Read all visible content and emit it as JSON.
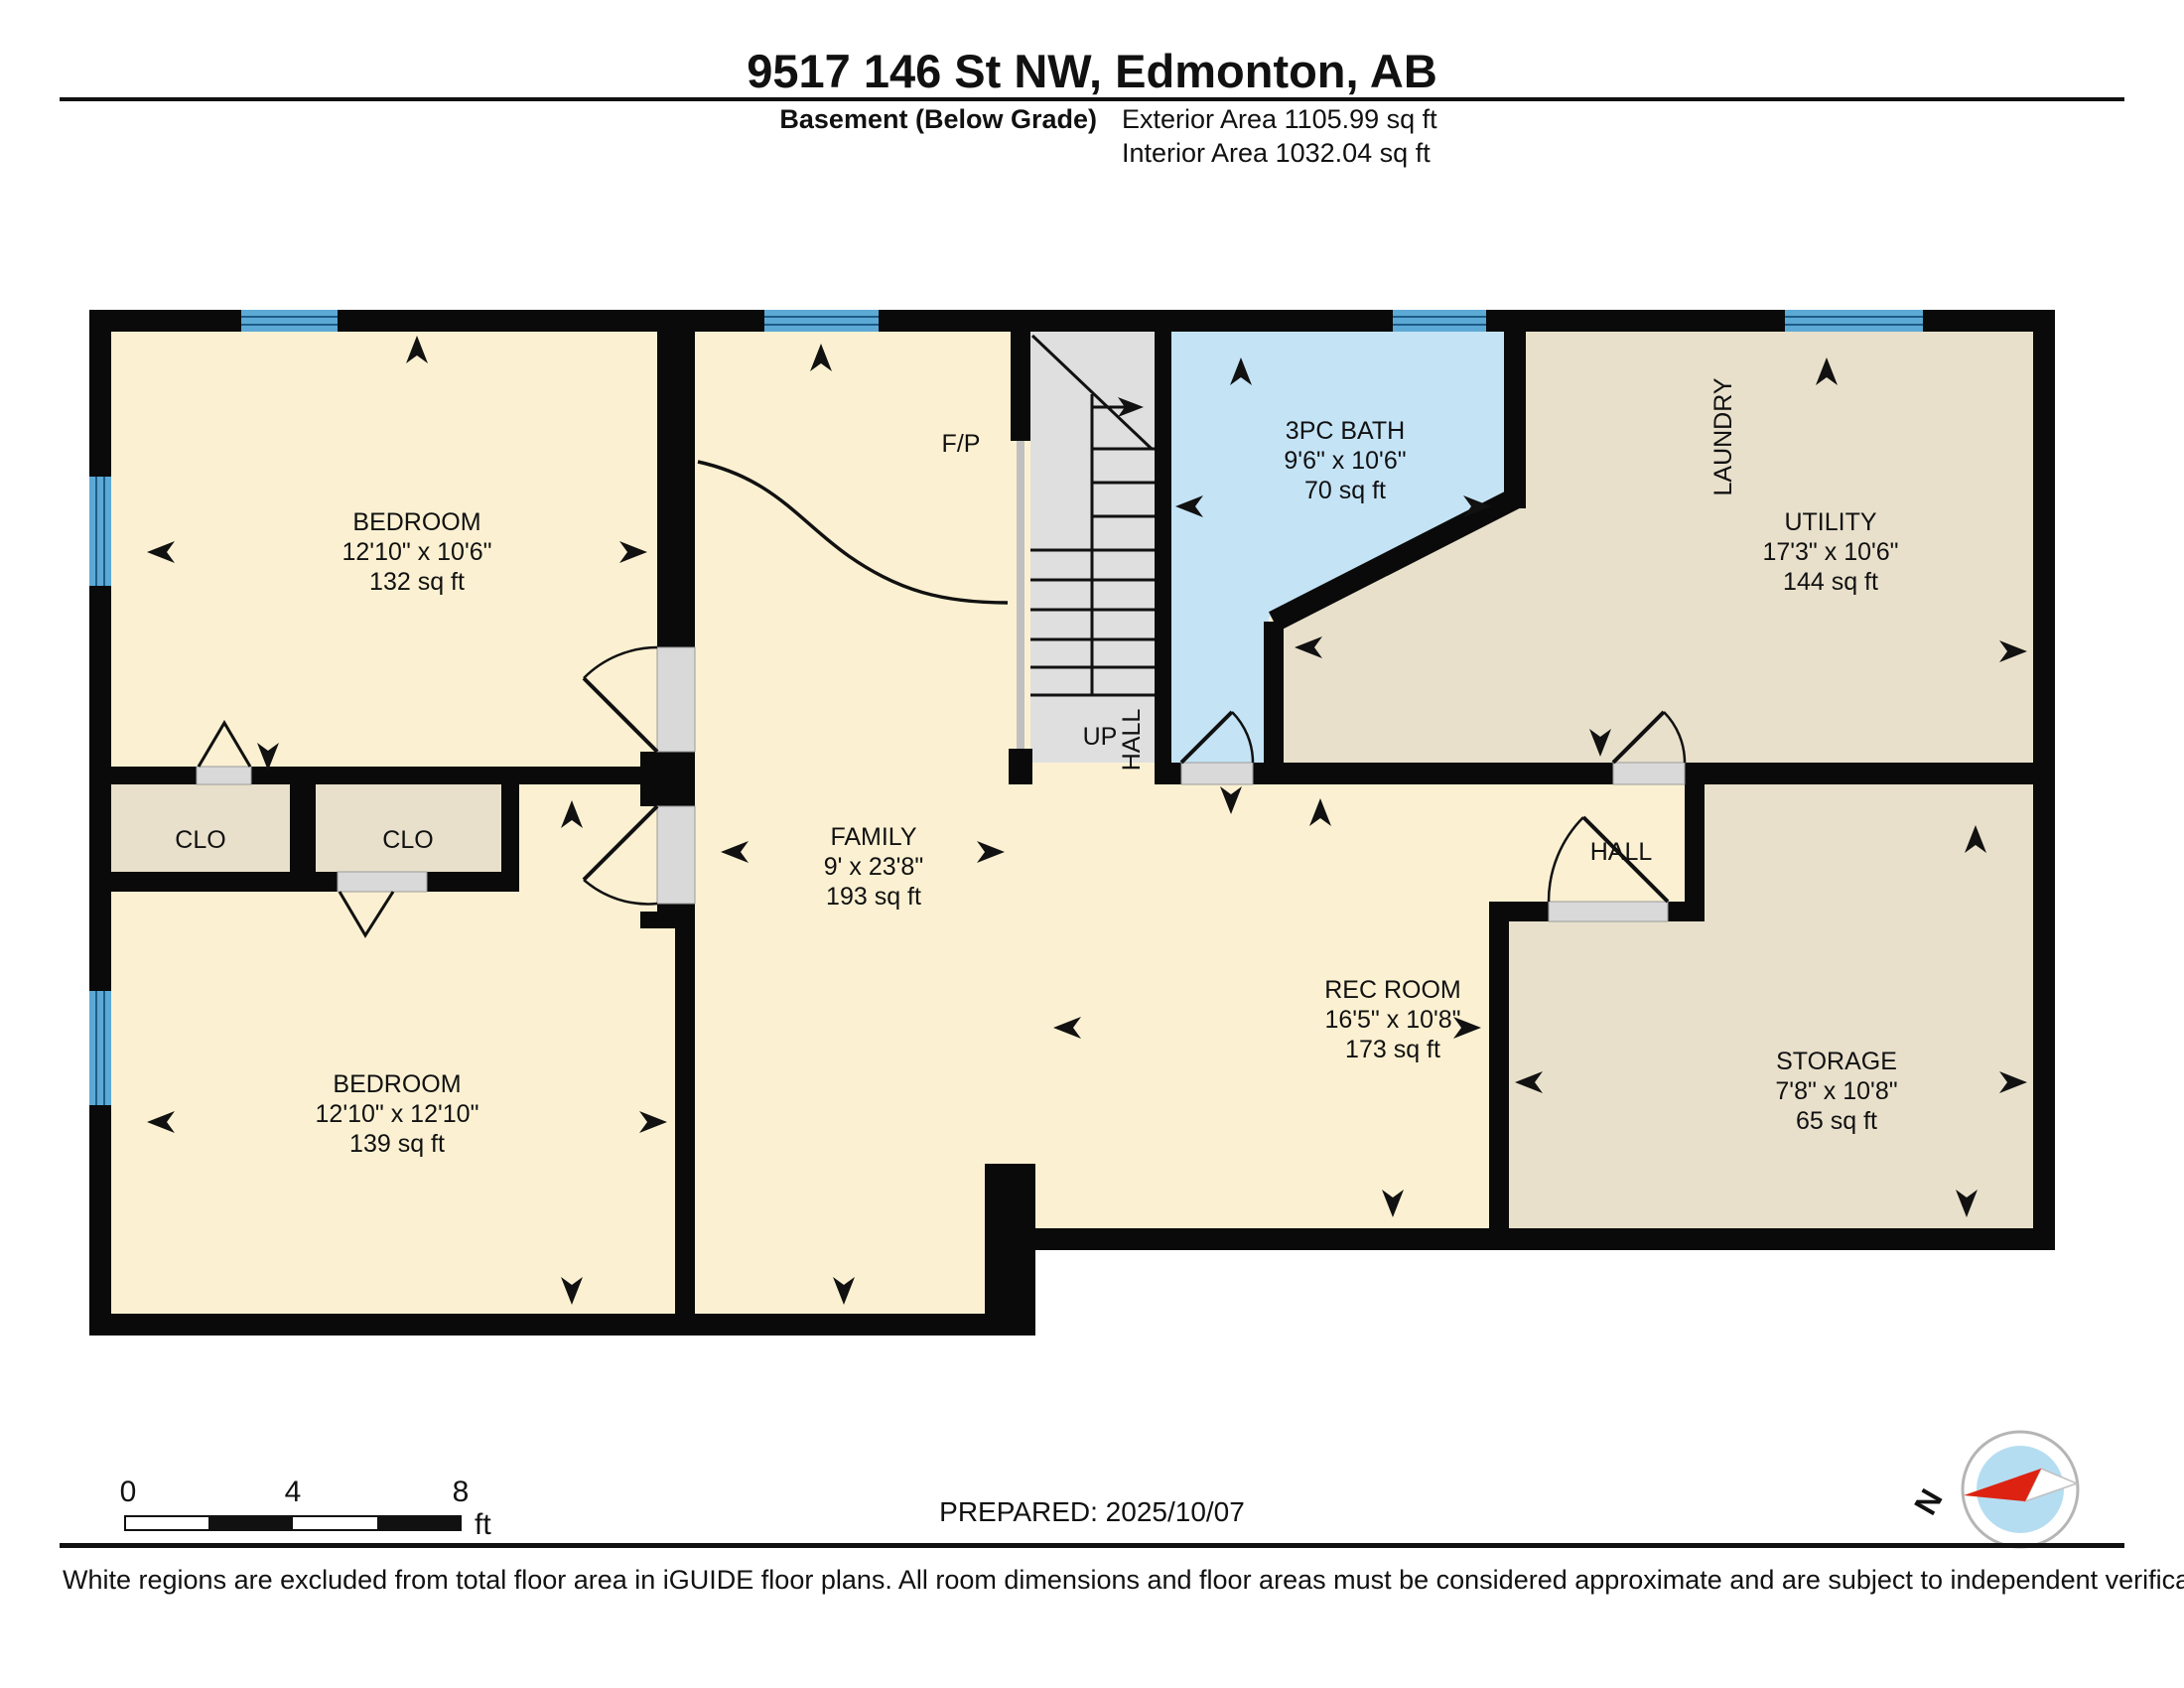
{
  "header": {
    "title": "9517 146 St NW, Edmonton, AB",
    "floor_label": "Basement (Below Grade)",
    "exterior_area": "Exterior Area 1105.99 sq ft",
    "interior_area": "Interior Area 1032.04 sq ft"
  },
  "rooms": [
    {
      "id": "bedroom-1",
      "name": "BEDROOM",
      "dims": "12'10\" x 10'6\"",
      "area": "132 sq ft"
    },
    {
      "id": "bedroom-2",
      "name": "BEDROOM",
      "dims": "12'10\" x 12'10\"",
      "area": "139 sq ft"
    },
    {
      "id": "family",
      "name": "FAMILY",
      "dims": "9' x 23'8\"",
      "area": "193 sq ft"
    },
    {
      "id": "bath",
      "name": "3PC BATH",
      "dims": "9'6\" x 10'6\"",
      "area": "70 sq ft"
    },
    {
      "id": "utility",
      "name": "UTILITY",
      "dims": "17'3\" x 10'6\"",
      "area": "144 sq ft"
    },
    {
      "id": "rec-room",
      "name": "REC ROOM",
      "dims": "16'5\" x 10'8\"",
      "area": "173 sq ft"
    },
    {
      "id": "storage",
      "name": "STORAGE",
      "dims": "7'8\" x 10'8\"",
      "area": "65 sq ft"
    }
  ],
  "labels": {
    "fireplace": "F/P",
    "up": "UP",
    "stair_hall": "HALL",
    "hall": "HALL",
    "laundry": "LAUNDRY",
    "closet_1": "CLO",
    "closet_2": "CLO"
  },
  "scale_bar": {
    "tick_0": "0",
    "tick_4": "4",
    "tick_8": "8",
    "unit": "ft"
  },
  "compass": {
    "north": "N"
  },
  "prepared": "PREPARED: 2025/10/07",
  "footer": "White regions are excluded from total floor area in iGUIDE floor plans. All room dimensions and floor areas must be considered approximate and are subject to independent verification.",
  "colors": {
    "floor": "#FBF1D2",
    "closet_tan": "#E8E0CB",
    "bath_blue": "#C4E4F6",
    "window_blue": "#5CA9D6",
    "window_line": "#1E5C86",
    "wall": "#0A0A0A",
    "stairs_gray": "#DFDFDF",
    "compass_red": "#DD2211",
    "compass_blue": "#B5DDF1"
  }
}
